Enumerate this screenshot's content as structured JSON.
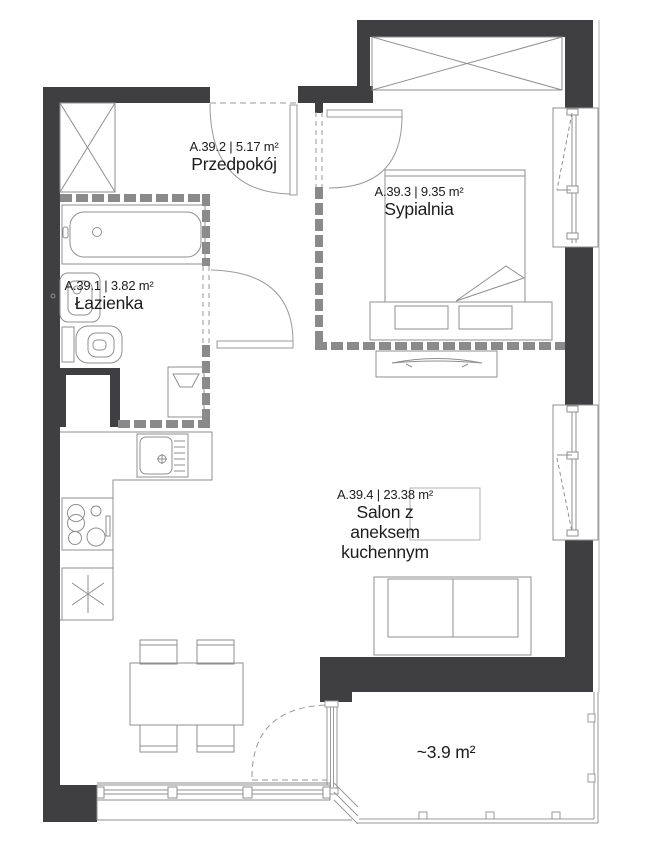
{
  "plan": {
    "rooms": {
      "hall": {
        "area": "A.39.2 | 5.17 m²",
        "name": "Przedpokój"
      },
      "bedroom": {
        "area": "A.39.3 | 9.35 m²",
        "name": "Sypialnia"
      },
      "bathroom": {
        "area": "A.39.1 | 3.82 m²",
        "name": "Łazienka"
      },
      "living": {
        "area": "A.39.4 | 23.38 m²",
        "name": "Salon z aneksem",
        "name2": "kuchennym"
      },
      "balcony": {
        "area": "~3.9 m²"
      }
    },
    "colors": {
      "wall": "#3f3f41",
      "partition": "#8a8a8a",
      "line": "#8f8f8f",
      "text": "#1c1c1c",
      "background": "#ffffff"
    }
  }
}
